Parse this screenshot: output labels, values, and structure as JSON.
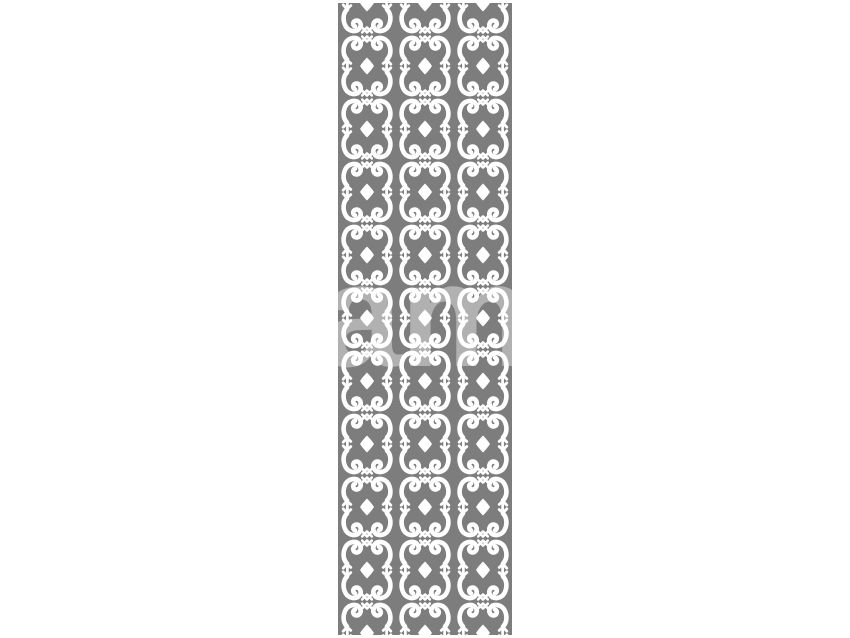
{
  "canvas": {
    "width": 850,
    "height": 638,
    "background": "#ffffff"
  },
  "panel": {
    "left": 338,
    "top": 3,
    "width": 174,
    "height": 632,
    "base_color": "#7d7d7d",
    "cutout_color": "#ffffff",
    "columns": 3,
    "column_width": 58,
    "row_period": 63,
    "motif": "mirrored scroll (ram's-horn) ornament pairs stacked vertically",
    "accent_shapes": [
      "diamond-between-rows",
      "spiral-curl",
      "trident-tip",
      "cross-star"
    ],
    "edge_detail": "half-diamond notches at top and bottom edges, plain gray margins at left and right"
  },
  "watermark": {
    "text": "alamy",
    "visible_portion_note": "large lowercase letters, only visible where they overlap the gray panel",
    "color": "rgba(255,255,255,0.40)"
  }
}
